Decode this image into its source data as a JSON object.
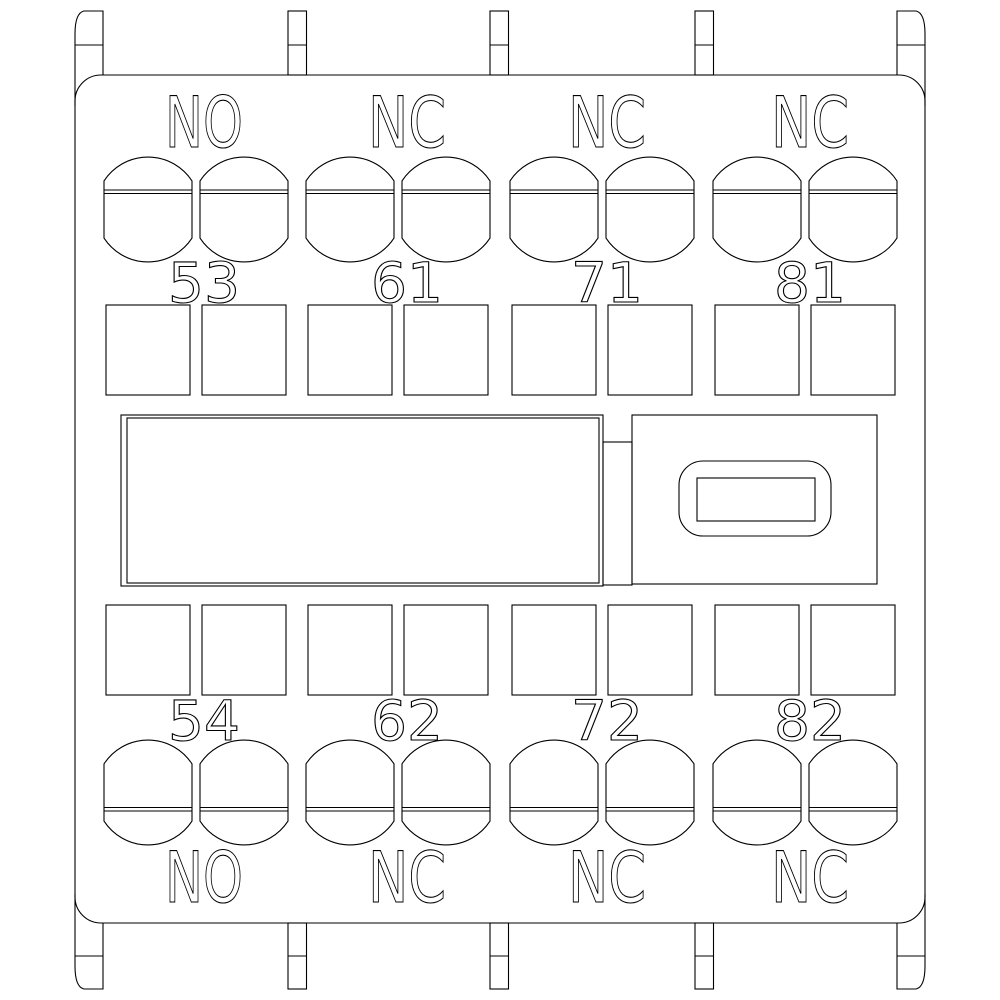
{
  "drawing": {
    "colors": {
      "line": "#000000",
      "background": "#ffffff"
    },
    "top_row": {
      "groups": [
        {
          "label": "NO",
          "terminal": "53"
        },
        {
          "label": "NC",
          "terminal": "61"
        },
        {
          "label": "NC",
          "terminal": "71"
        },
        {
          "label": "NC",
          "terminal": "81"
        }
      ]
    },
    "bottom_row": {
      "groups": [
        {
          "label": "NO",
          "terminal": "54"
        },
        {
          "label": "NC",
          "terminal": "62"
        },
        {
          "label": "NC",
          "terminal": "72"
        },
        {
          "label": "NC",
          "terminal": "82"
        }
      ]
    }
  }
}
